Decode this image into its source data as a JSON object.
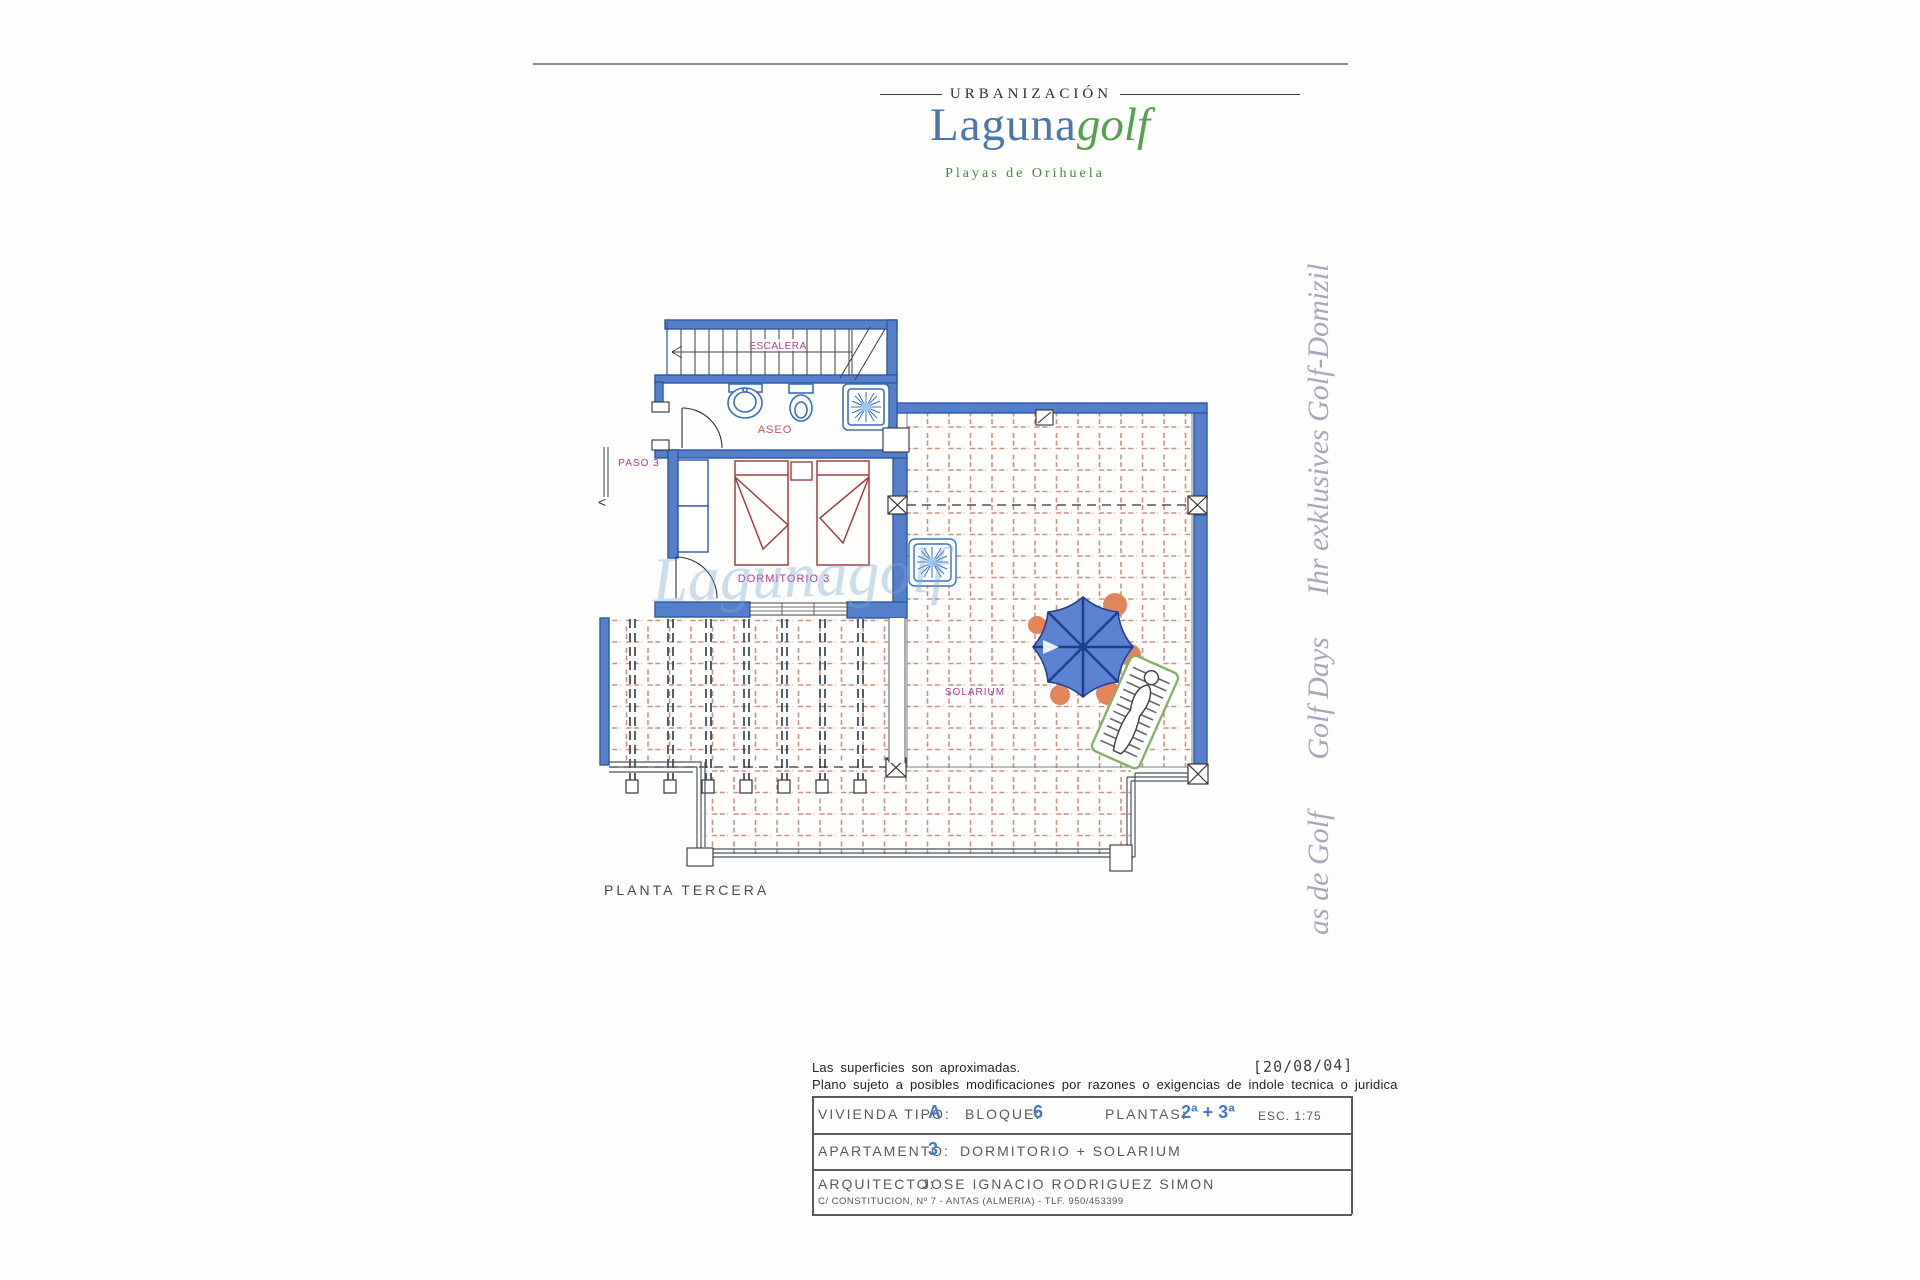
{
  "header": {
    "eyebrow": "URBANIZACIÓN",
    "brand_primary": "Laguna",
    "brand_secondary": "golf",
    "tagline": "Playas de Orihuela"
  },
  "watermark": {
    "segments": [
      "as de Golf",
      "Golf Days",
      "Ihr exklusives Golf-Domizil"
    ]
  },
  "plan": {
    "ghost_text": "Lagunagolf",
    "labels": {
      "escalera": "ESCALERA",
      "aseo": "ASEO",
      "paso": "PASO 3",
      "dormitorio": "DORMITORIO 3",
      "solarium": "SOLARIUM",
      "floor_caption": "PLANTA TERCERA"
    }
  },
  "title_block": {
    "disclaimer_line1": "Las superficies son aproximadas.",
    "disclaimer_line2": "Plano sujeto a posibles modificaciones por razones o exigencias de indole tecnica o juridica",
    "date_stamp": "[20/08/04]",
    "vivienda_label": "VIVIENDA TIPO:",
    "vivienda_value": "A",
    "bloque_label": "BLOQUE:",
    "bloque_value": "6",
    "plantas_label": "PLANTAS:",
    "plantas_value": "2ª + 3ª",
    "escala": "ESC. 1:75",
    "apartamento_label": "APARTAMENTO:",
    "apartamento_value": "3",
    "apartamento_desc": "DORMITORIO + SOLARIUM",
    "arquitecto_label": "ARQUITECTO:",
    "arquitecto_value": "JOSE IGNACIO RODRIGUEZ SIMON",
    "address": "C/ CONSTITUCION, Nº 7 - ANTAS (ALMERIA) - TLF. 950/453399"
  },
  "colors": {
    "wall_blue": "#567fc9",
    "wall_blue_dark": "#2a57a8",
    "fixture_blue": "#3b6fc0",
    "tile_salmon": "#cf8f7f",
    "label_magenta": "#b03a90",
    "value_blue": "#477ac2",
    "brand_blue": "#4c74ad",
    "brand_green": "#55a04e",
    "watermark_gray": "#a6a8ba",
    "umbrella_blue": "#5b82d0",
    "umbrella_orange": "#e2855c",
    "lounger_green": "#86b06a"
  }
}
